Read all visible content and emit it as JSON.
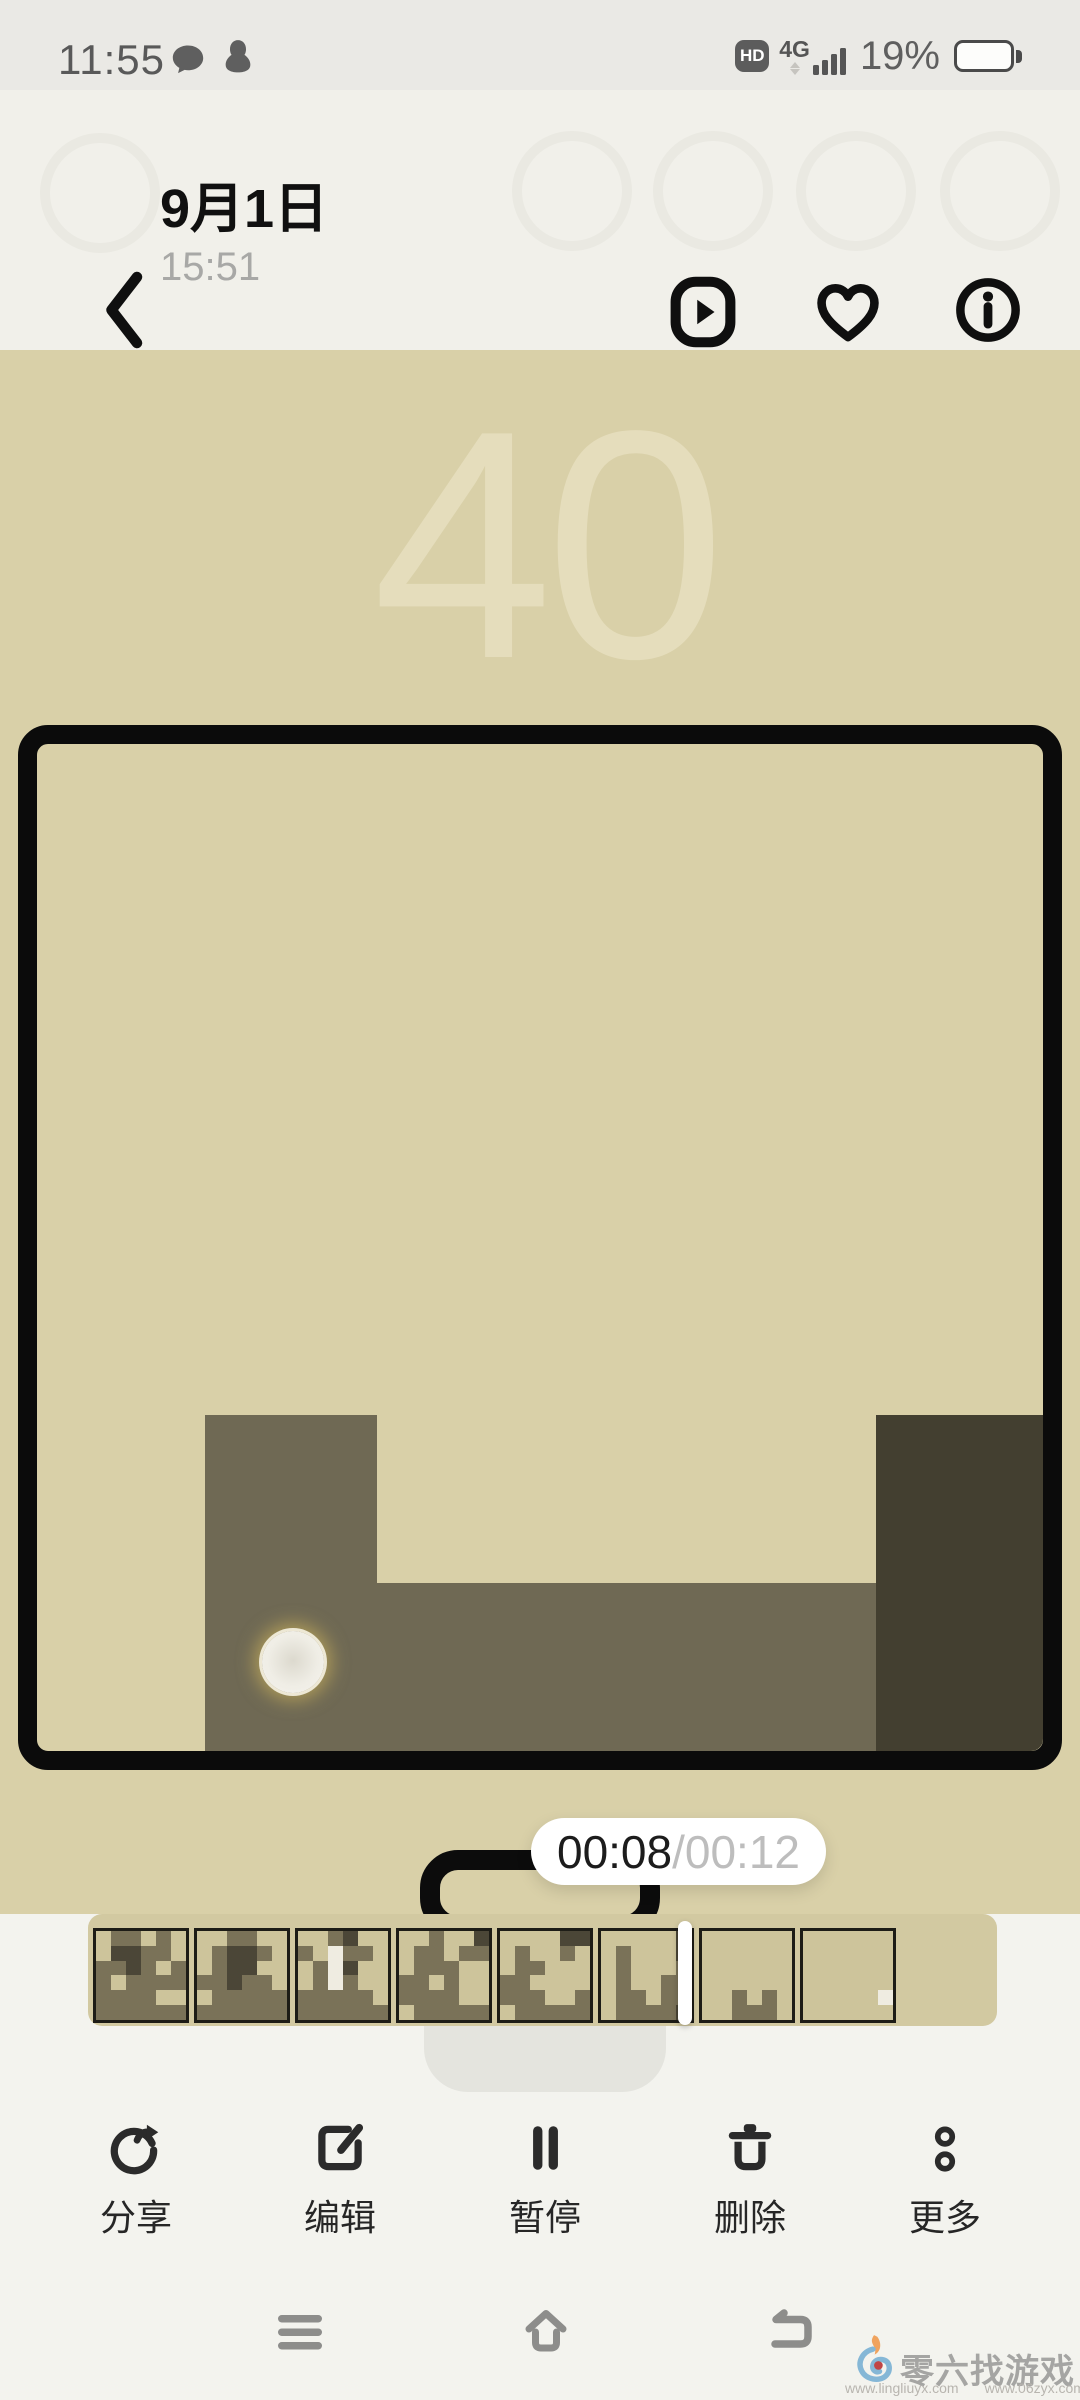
{
  "status_bar": {
    "time": "11:55",
    "hd_badge": "HD",
    "network": "4G",
    "battery_percent": "19%",
    "signal_bar_heights": [
      10,
      15,
      21,
      27
    ]
  },
  "header": {
    "title": "9月1日",
    "subtitle": "15:51"
  },
  "video": {
    "score_watermark": "40",
    "timer": {
      "current": "00:08",
      "separator": "/",
      "total": "00:12"
    }
  },
  "game": {
    "colors": {
      "board": "#d9d0a8",
      "block": "#6f6954",
      "block_dark": "#433f30"
    },
    "blocks": [
      {
        "x": 168,
        "y": 671,
        "w": 172,
        "h": 337,
        "color": "#6f6954"
      },
      {
        "x": 340,
        "y": 839,
        "w": 499,
        "h": 169,
        "color": "#6f6954"
      },
      {
        "x": 839,
        "y": 671,
        "w": 169,
        "h": 337,
        "color": "#433f30"
      }
    ],
    "ball": {
      "x": 225,
      "y": 887,
      "size": 62
    }
  },
  "filmstrip": {
    "cell_colors": {
      "0": "transparent",
      "1": "#7a7258",
      "2": "#4b4637",
      "3": "#efece1"
    },
    "thumb_left_start": 93,
    "thumb_pitch": 101,
    "thumbnails": [
      {
        "grid": [
          "011010",
          "022110",
          "112101",
          "101111",
          "111100",
          "111111"
        ]
      },
      {
        "grid": [
          "001100",
          "012210",
          "012200",
          "112110",
          "011111",
          "111111"
        ]
      },
      {
        "grid": [
          "001200",
          "103110",
          "013200",
          "013100",
          "111110",
          "111111"
        ]
      },
      {
        "grid": [
          "001002",
          "011011",
          "011100",
          "110100",
          "111100",
          "011111"
        ]
      },
      {
        "grid": [
          "000022",
          "010010",
          "011000",
          "110000",
          "111001",
          "011111"
        ]
      },
      {
        "grid": [
          "000002",
          "010002",
          "010001",
          "010011",
          "011011",
          "011112"
        ]
      },
      {
        "grid": [
          "000000",
          "000000",
          "000000",
          "000000",
          "001010",
          "001110"
        ]
      },
      {
        "grid": [
          "000000",
          "000000",
          "000000",
          "000000",
          "000003",
          "000000"
        ]
      }
    ]
  },
  "toolbar": {
    "items": [
      {
        "icon": "share-icon",
        "label": "分享"
      },
      {
        "icon": "edit-icon",
        "label": "编辑"
      },
      {
        "icon": "pause-icon",
        "label": "暂停"
      },
      {
        "icon": "delete-icon",
        "label": "删除"
      },
      {
        "icon": "more-icon",
        "label": "更多"
      }
    ]
  },
  "watermark": {
    "site_name": "零六找游戏",
    "url_left": "www.lingliuyx.com",
    "url_right": "www.06zyx.com"
  }
}
